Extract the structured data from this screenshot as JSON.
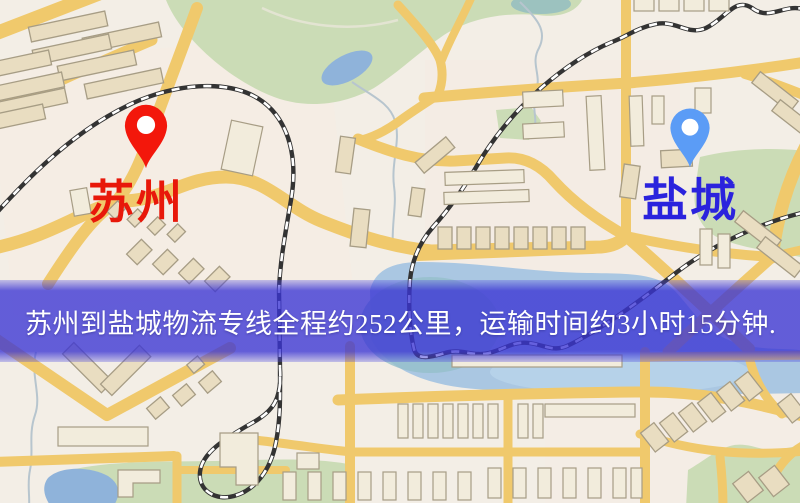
{
  "banner": {
    "text": "苏州到盐城物流专线全程约252公里，运输时间约3小时15分钟.",
    "bg_color": "rgba(58,52,212,0.78)",
    "text_color": "#ffffff"
  },
  "markers": {
    "origin": {
      "name": "苏州",
      "pin_color": "#f3170b",
      "label_color": "#e8180a"
    },
    "destination": {
      "name": "盐城",
      "pin_color": "#5b9cf6",
      "label_color": "#2b23dd"
    }
  },
  "theme": {
    "bg": "#f3eee6",
    "road": "#f0c96c",
    "park": "#cbdcb6",
    "water": "#8fb3da",
    "water2": "#aac7e2",
    "building": "#e9ddc1",
    "building2": "#f2ecdc",
    "building-edge": "#a79d85",
    "rail": "#333333",
    "rail-dash": "#ffffff",
    "banner-bg": "rgba(58,52,212,0.78)",
    "banner-text": "#ffffff",
    "origin-label": "#e8180a",
    "dest-label": "#2b23dd",
    "origin-pin": "#f3170b",
    "dest-pin": "#5b9cf6",
    "pin-hole": "#ffffff"
  }
}
